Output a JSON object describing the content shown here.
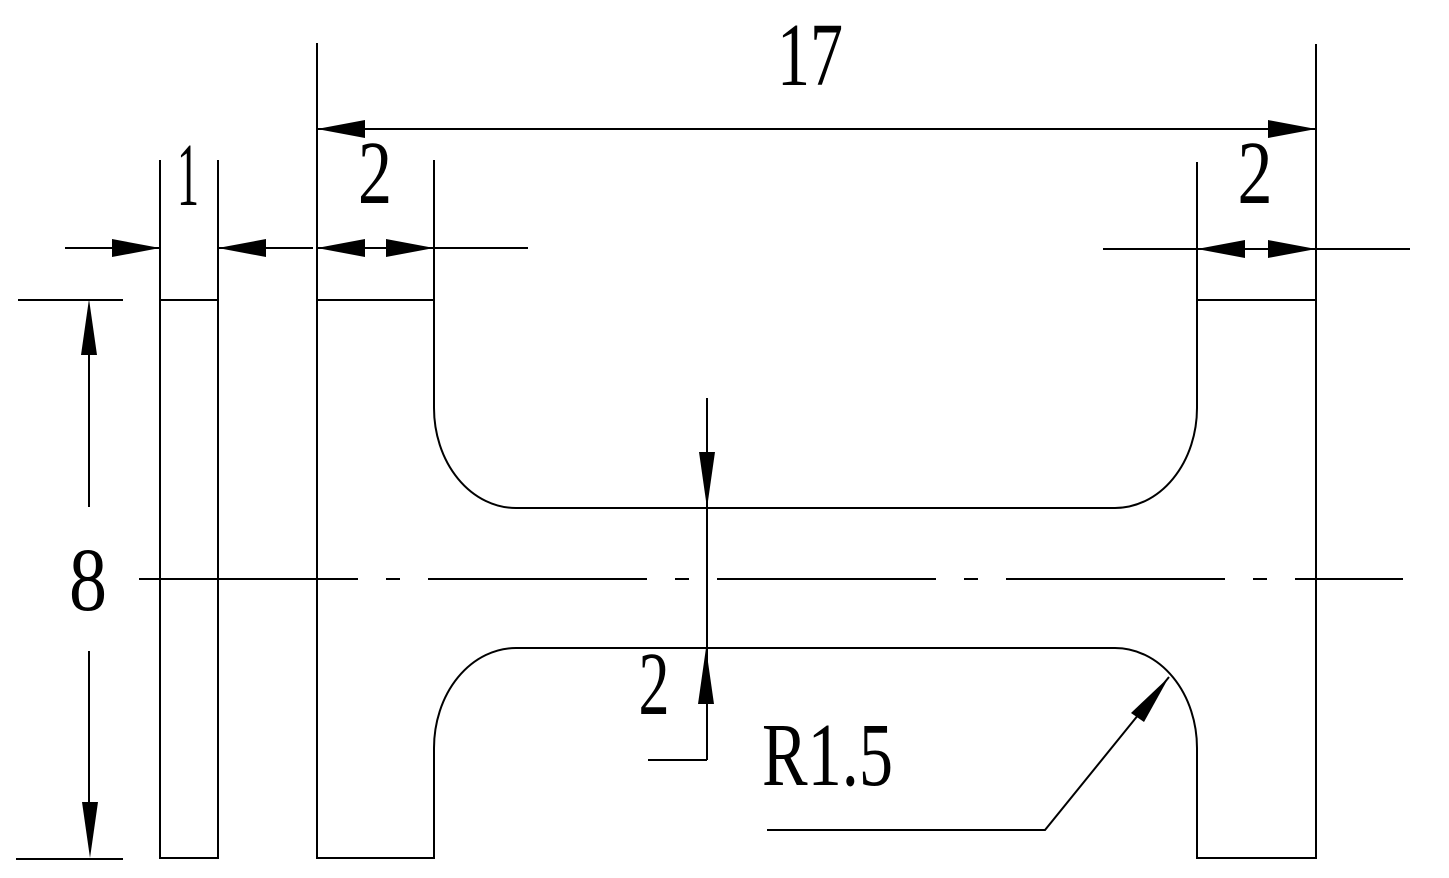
{
  "drawing": {
    "background_color": "#ffffff",
    "line_color": "#000000",
    "dimensions": {
      "overall_width": {
        "value": "17"
      },
      "slice_thickness": {
        "value": "1"
      },
      "left_flange_width": {
        "value": "2"
      },
      "right_flange_width": {
        "value": "2"
      },
      "overall_height": {
        "value": "8"
      },
      "web_thickness": {
        "value": "2"
      },
      "fillet_radius": {
        "value": "R1.5"
      }
    }
  }
}
